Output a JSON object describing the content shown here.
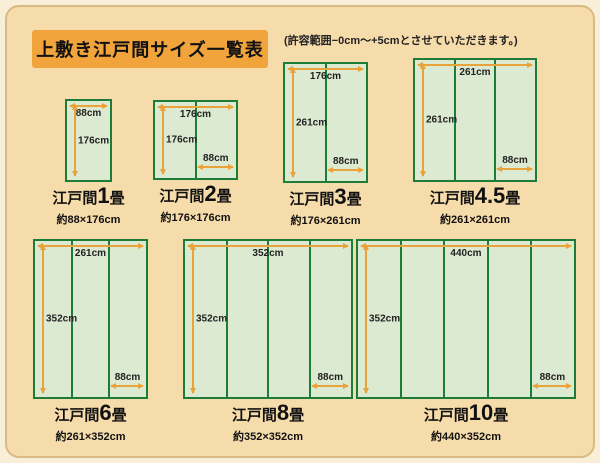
{
  "page": {
    "title": "上敷き江戸間サイズ一覧表",
    "note": "(許容範囲−0cm〜+5cmとさせていただきます。)"
  },
  "colors": {
    "outer_background": "#f9efd8",
    "card_background": "#f7dcab",
    "card_border": "#d9ba82",
    "title_box": "#f1a33c",
    "mat_fill": "#dcead2",
    "mat_border": "#1e7c39",
    "dimension_arrow": "#eaa33b"
  },
  "mats": {
    "m1": {
      "prefix": "江戸間",
      "num": "1",
      "suffix": "畳",
      "size": "約88×176cm",
      "top": "88cm",
      "left": "176cm"
    },
    "m2": {
      "prefix": "江戸間",
      "num": "2",
      "suffix": "畳",
      "size": "約176×176cm",
      "top": "176cm",
      "left": "176cm",
      "bottom": "88cm"
    },
    "m3": {
      "prefix": "江戸間",
      "num": "3",
      "suffix": "畳",
      "size": "約176×261cm",
      "top": "176cm",
      "left": "261cm",
      "bottom": "88cm"
    },
    "m45": {
      "prefix": "江戸間",
      "num": "4.5",
      "suffix": "畳",
      "size": "約261×261cm",
      "top": "261cm",
      "left": "261cm",
      "bottom": "88cm"
    },
    "m6": {
      "prefix": "江戸間",
      "num": "6",
      "suffix": "畳",
      "size": "約261×352cm",
      "top": "261cm",
      "left": "352cm",
      "bottom": "88cm"
    },
    "m8": {
      "prefix": "江戸間",
      "num": "8",
      "suffix": "畳",
      "size": "約352×352cm",
      "top": "352cm",
      "left": "352cm",
      "bottom": "88cm"
    },
    "m10": {
      "prefix": "江戸間",
      "num": "10",
      "suffix": "畳",
      "size": "約440×352cm",
      "top": "440cm",
      "left": "352cm",
      "bottom": "88cm"
    }
  }
}
